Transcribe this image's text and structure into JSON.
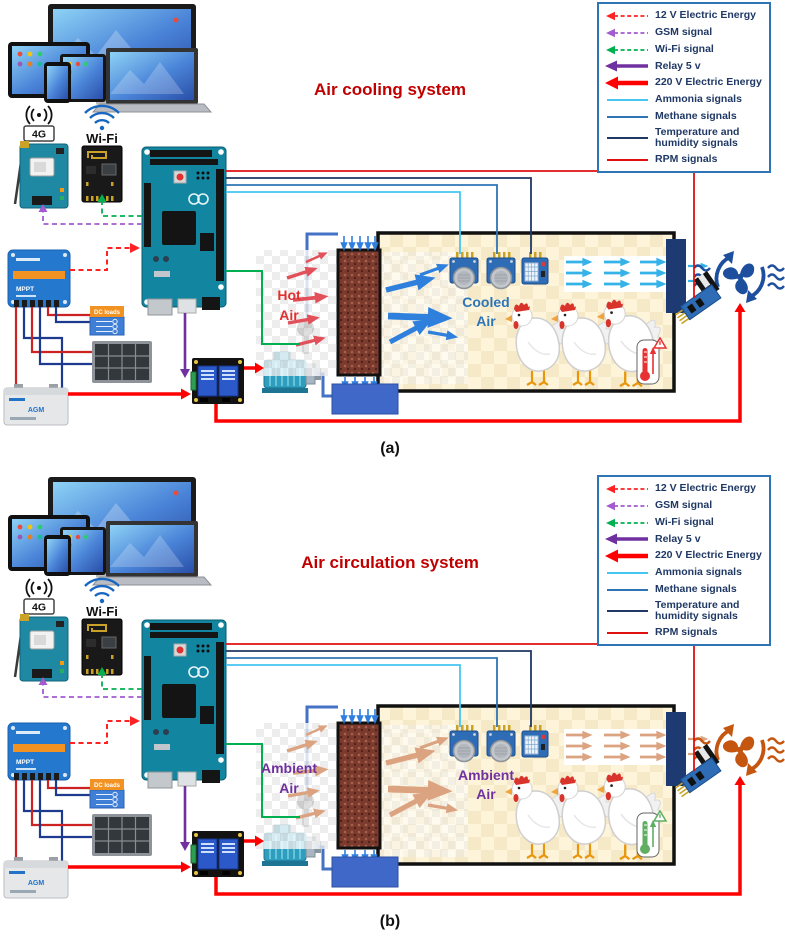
{
  "legend": {
    "border_color": "#2e75b6",
    "text_color": "#1f3864",
    "items": [
      {
        "label": "12 V Electric Energy",
        "color": "#ff2222",
        "line": "dashed",
        "arrow": true
      },
      {
        "label": "GSM signal",
        "color": "#a35bcf",
        "line": "dashed",
        "arrow": true
      },
      {
        "label": "Wi-Fi signal",
        "color": "#00b050",
        "line": "dashed",
        "arrow": true
      },
      {
        "label": "Relay 5 v",
        "color": "#7030a0",
        "line": "solid-thick",
        "arrow": true
      },
      {
        "label": "220 V Electric Energy",
        "color": "#ff0000",
        "line": "solid-heavy",
        "arrow": true
      },
      {
        "label": "Ammonia signals",
        "color": "#45c6f0",
        "line": "solid",
        "arrow": false
      },
      {
        "label": "Methane signals",
        "color": "#2e75b6",
        "line": "solid",
        "arrow": false
      },
      {
        "label": "Temperature and humidity signals",
        "color": "#1f3864",
        "line": "solid",
        "arrow": false
      },
      {
        "label": "RPM signals",
        "color": "#e01010",
        "line": "solid",
        "arrow": false
      }
    ]
  },
  "components": {
    "gsm_label": "4G",
    "wifi_label": "Wi-Fi",
    "dc_loads_label": "DC loads",
    "mppt_label": "MPPT",
    "battery_label": "AGM"
  },
  "panels": [
    {
      "letter": "(a)",
      "title": "Air cooling system",
      "title_color": "#c00000",
      "left_air": {
        "line1": "Hot",
        "line2": "Air",
        "label_color": "#e03131",
        "arrow_color": "#e2505a"
      },
      "inner_air": {
        "line1": "Cooled",
        "line2": "Air",
        "label_color": "#2e75b6",
        "arrow_color": "#2f80dd"
      },
      "exhaust_color": "#35b2e8",
      "fan_color": "#1d4f9e",
      "thermometer_color": "#e63232"
    },
    {
      "letter": "(b)",
      "title": "Air circulation system",
      "title_color": "#c00000",
      "left_air": {
        "line1": "Ambient",
        "line2": "Air",
        "label_color": "#7030a0",
        "arrow_color": "#dca380"
      },
      "inner_air": {
        "line1": "Ambient",
        "line2": "Air",
        "label_color": "#7030a0",
        "arrow_color": "#dca380"
      },
      "exhaust_color": "#dca380",
      "fan_color": "#c5560f",
      "thermometer_color": "#5fae62"
    }
  ]
}
